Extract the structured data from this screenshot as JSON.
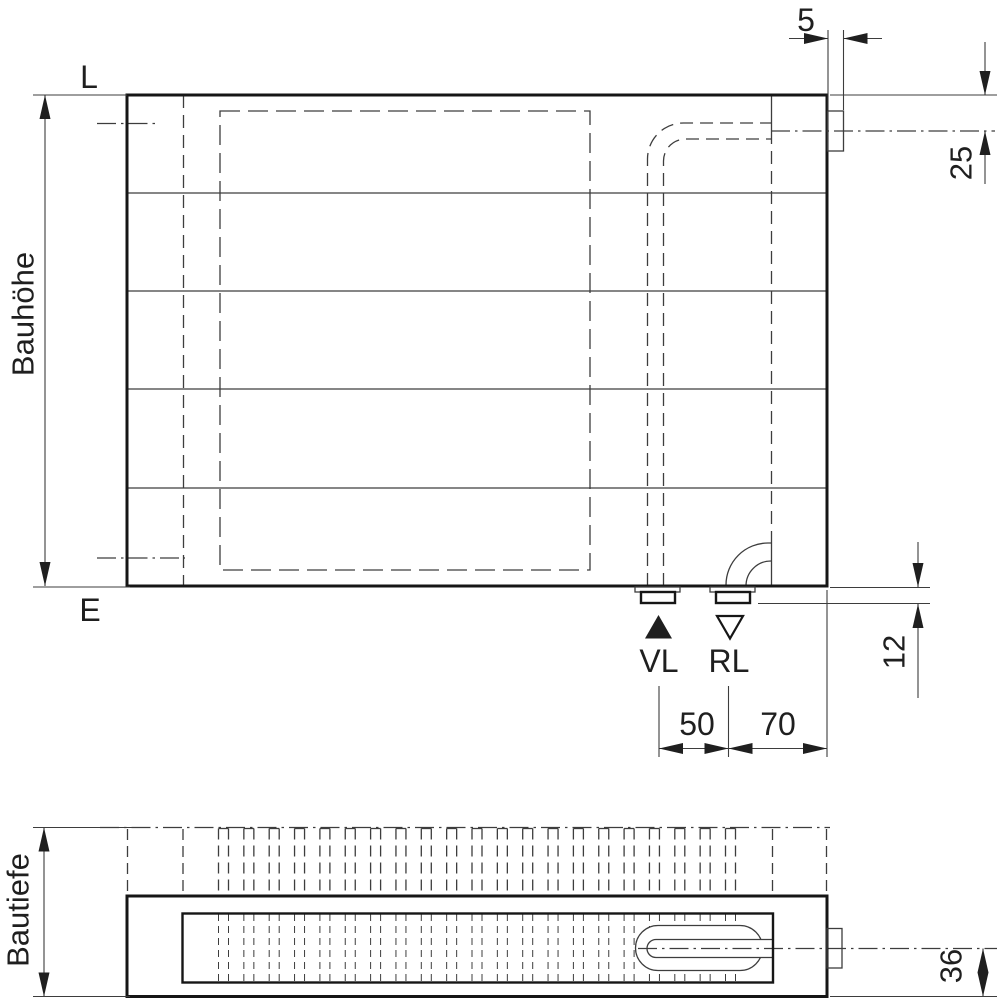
{
  "colors": {
    "background": "#ffffff",
    "line_thin": "#3d3d3d",
    "line_thick": "#161616",
    "text": "#1f1f1f"
  },
  "front_view": {
    "vent_mark": "L",
    "drain_mark": "E",
    "height_label": "Bauhöhe",
    "supply_label": "VL",
    "return_label": "RL",
    "dims": {
      "tapping_width": "5",
      "top_offset": "25",
      "bottom_offset": "12",
      "supply_spacing": "50",
      "edge_offset": "70"
    }
  },
  "plan_view": {
    "depth_label": "Bautiefe",
    "dims": {
      "pipe_center_height": "36"
    }
  }
}
